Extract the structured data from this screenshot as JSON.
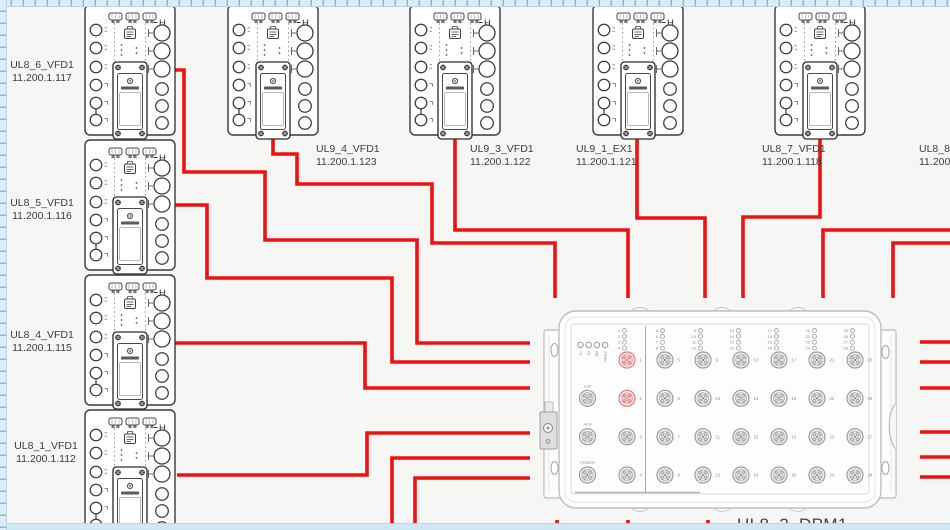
{
  "colors": {
    "canvas_bg": "#f6f6f4",
    "cable": "#ee1111",
    "device_stroke": "#3a3a3a",
    "dpm_stroke": "#bdbdbd",
    "label_text": "#3c3c3c",
    "ruler_track": "#dcedf8",
    "ruler_tick": "#8ab9d6",
    "ruler_border": "#b7d6e8",
    "bottom_strip": "#cfe8f5",
    "port_highlight": "#e07a7a"
  },
  "device_glyph": {
    "h_symbol": "H"
  },
  "devices": [
    {
      "name": "UL8_6_VFD1",
      "ip": "11.200.1.117",
      "x": 85,
      "y": 5,
      "label": {
        "x": 1,
        "y": 59,
        "align": "center"
      }
    },
    {
      "name": "UL8_5_VFD1",
      "ip": "11.200.1.116",
      "x": 85,
      "y": 140,
      "label": {
        "x": 1,
        "y": 197,
        "align": "center"
      }
    },
    {
      "name": "UL8_4_VFD1",
      "ip": "11.200.1.115",
      "x": 85,
      "y": 275,
      "label": {
        "x": 1,
        "y": 329,
        "align": "center"
      }
    },
    {
      "name": "UL8_1_VFD1",
      "ip": "11.200.1.112",
      "x": 85,
      "y": 410,
      "label": {
        "x": 5,
        "y": 440,
        "align": "center"
      }
    },
    {
      "name": "UL9_4_VFD1",
      "ip": "11.200.1.123",
      "x": 228,
      "y": 5,
      "label": {
        "x": 316,
        "y": 143,
        "align": "left"
      }
    },
    {
      "name": "UL9_3_VFD1",
      "ip": "11.200.1.122",
      "x": 410,
      "y": 5,
      "label": {
        "x": 470,
        "y": 143,
        "align": "left"
      }
    },
    {
      "name": "UL9_1_EX1",
      "ip": "11.200.1.121",
      "x": 593,
      "y": 5,
      "label": {
        "x": 576,
        "y": 143,
        "align": "left"
      }
    },
    {
      "name": "UL8_7_VFD1",
      "ip": "11.200.1.118",
      "x": 775,
      "y": 5,
      "label": {
        "x": 762,
        "y": 143,
        "align": "left"
      }
    }
  ],
  "edge_label": {
    "name": "UL8_8_V",
    "ip": "11.200.",
    "label": {
      "x": 919,
      "y": 143,
      "align": "left"
    }
  },
  "dpm": {
    "name": "UL8_2_DPM1",
    "label": {
      "x": 737,
      "y": 515
    },
    "status_leds": [
      "P1",
      "P2",
      "RM",
      "FAULT"
    ],
    "side_connectors": [
      "V.24",
      "ACA",
      "POWER"
    ],
    "port_numbers": [
      1,
      2,
      3,
      4,
      5,
      6,
      7,
      8,
      9,
      10,
      11,
      12,
      13,
      14,
      15,
      16,
      17,
      18,
      19,
      20,
      21,
      22,
      23,
      24,
      25,
      26,
      27,
      28
    ],
    "highlighted_ports": [
      1,
      2
    ]
  },
  "cables": [
    {
      "from": "UL8_6_VFD1",
      "points": [
        [
          175,
          70
        ],
        [
          184,
          70
        ],
        [
          184,
          172
        ],
        [
          265,
          172
        ],
        [
          265,
          240
        ],
        [
          417,
          240
        ],
        [
          417,
          343
        ],
        [
          530,
          343
        ]
      ]
    },
    {
      "from": "UL8_5_VFD1",
      "points": [
        [
          175,
          205
        ],
        [
          207,
          205
        ],
        [
          207,
          278
        ],
        [
          392,
          278
        ],
        [
          392,
          362
        ],
        [
          530,
          362
        ]
      ]
    },
    {
      "from": "UL8_4_VFD1",
      "points": [
        [
          175,
          343
        ],
        [
          365,
          343
        ],
        [
          365,
          388
        ],
        [
          530,
          388
        ]
      ]
    },
    {
      "from": "UL8_1_VFD1",
      "points": [
        [
          177,
          475
        ],
        [
          367,
          475
        ],
        [
          367,
          433
        ],
        [
          530,
          433
        ]
      ]
    },
    {
      "from": "UL9_4_VFD1",
      "points": [
        [
          273,
          136
        ],
        [
          273,
          154
        ],
        [
          297,
          154
        ],
        [
          297,
          184
        ],
        [
          432,
          184
        ],
        [
          432,
          243
        ],
        [
          555,
          243
        ],
        [
          555,
          298
        ]
      ]
    },
    {
      "from": "UL9_3_VFD1",
      "points": [
        [
          455,
          136
        ],
        [
          455,
          230
        ],
        [
          628,
          230
        ],
        [
          628,
          298
        ]
      ]
    },
    {
      "from": "UL9_1_EX1",
      "points": [
        [
          637,
          136
        ],
        [
          637,
          218
        ],
        [
          705,
          218
        ],
        [
          705,
          298
        ]
      ]
    },
    {
      "from": "UL8_7_VFD1",
      "points": [
        [
          820,
          136
        ],
        [
          820,
          217
        ],
        [
          743,
          217
        ],
        [
          743,
          298
        ]
      ]
    },
    {
      "from": "right-edge",
      "points": [
        [
          950,
          230
        ],
        [
          823,
          230
        ],
        [
          823,
          298
        ]
      ]
    },
    {
      "from": "right-edge",
      "points": [
        [
          950,
          243
        ],
        [
          893,
          243
        ],
        [
          893,
          298
        ]
      ]
    },
    {
      "from": "bottom-edge",
      "points": [
        [
          392,
          530
        ],
        [
          392,
          458
        ],
        [
          530,
          458
        ]
      ]
    },
    {
      "from": "bottom-edge",
      "points": [
        [
          415,
          530
        ],
        [
          415,
          478
        ],
        [
          530,
          478
        ]
      ]
    },
    {
      "from": "right-stub",
      "points": [
        [
          920,
          342
        ],
        [
          950,
          342
        ]
      ]
    },
    {
      "from": "right-stub",
      "points": [
        [
          920,
          362
        ],
        [
          950,
          362
        ]
      ]
    },
    {
      "from": "right-stub",
      "points": [
        [
          920,
          388
        ],
        [
          950,
          388
        ]
      ]
    },
    {
      "from": "right-stub",
      "points": [
        [
          920,
          432
        ],
        [
          950,
          432
        ]
      ]
    },
    {
      "from": "right-stub",
      "points": [
        [
          920,
          457
        ],
        [
          950,
          457
        ]
      ]
    },
    {
      "from": "right-stub",
      "points": [
        [
          920,
          477
        ],
        [
          950,
          477
        ]
      ]
    },
    {
      "from": "bottom-stub",
      "points": [
        [
          557,
          520
        ],
        [
          557,
          530
        ]
      ]
    },
    {
      "from": "bottom-stub",
      "points": [
        [
          628,
          520
        ],
        [
          628,
          530
        ]
      ]
    },
    {
      "from": "bottom-stub",
      "points": [
        [
          708,
          520
        ],
        [
          708,
          530
        ]
      ]
    }
  ]
}
